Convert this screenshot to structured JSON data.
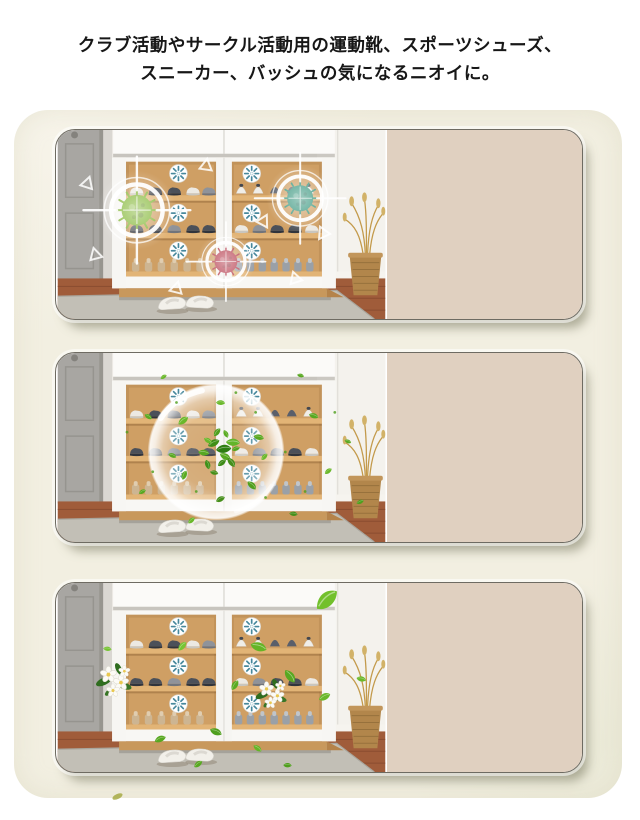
{
  "heading": {
    "line1": "クラブ活動やサークル活動用の運動靴、スポーツシューズ、",
    "line2": "スニーカー、バッシュの気になるニオイに。"
  },
  "colors": {
    "page_bg": "#ffffff",
    "board_bg": "#f2efe1",
    "panel_side_beige": "#e0d0c0",
    "panel_border": "#6e6b62",
    "cabinet_wood": "#c2935a",
    "shelf_wood": "#e2b476",
    "cabinet_white": "#f8f7f4",
    "door_gray": "#a8a6a2",
    "floor_wood": "#a05c3a",
    "rug_gray": "#c2bfb6",
    "germ_green": "#7db32c",
    "germ_teal": "#2d9077",
    "germ_red": "#b23345",
    "leaf_green": "#6ab82b",
    "flower_white": "#fcfbf6",
    "disc_spoke": "#47889c",
    "target_white": "#ffffff"
  },
  "panels": [
    {
      "name": "germs-targeted-on-shoe-cabinet",
      "side_color": "#e0d0c0"
    },
    {
      "name": "deodorizing-bubble-with-leaves",
      "side_color": "#e0d0c0"
    },
    {
      "name": "fresh-cabinet-leaves-and-flowers",
      "side_color": "#e0d0c0"
    }
  ],
  "icons": {
    "germ": "spiky-virus-blob",
    "target": "white-crosshair-rings",
    "deodorizer_disc": "white-disc-radial-spokes",
    "bubble": "translucent-sphere",
    "leaf": "green-leaf",
    "flower": "white-five-petal-bloom",
    "triangle": "white-outline-triangle"
  }
}
